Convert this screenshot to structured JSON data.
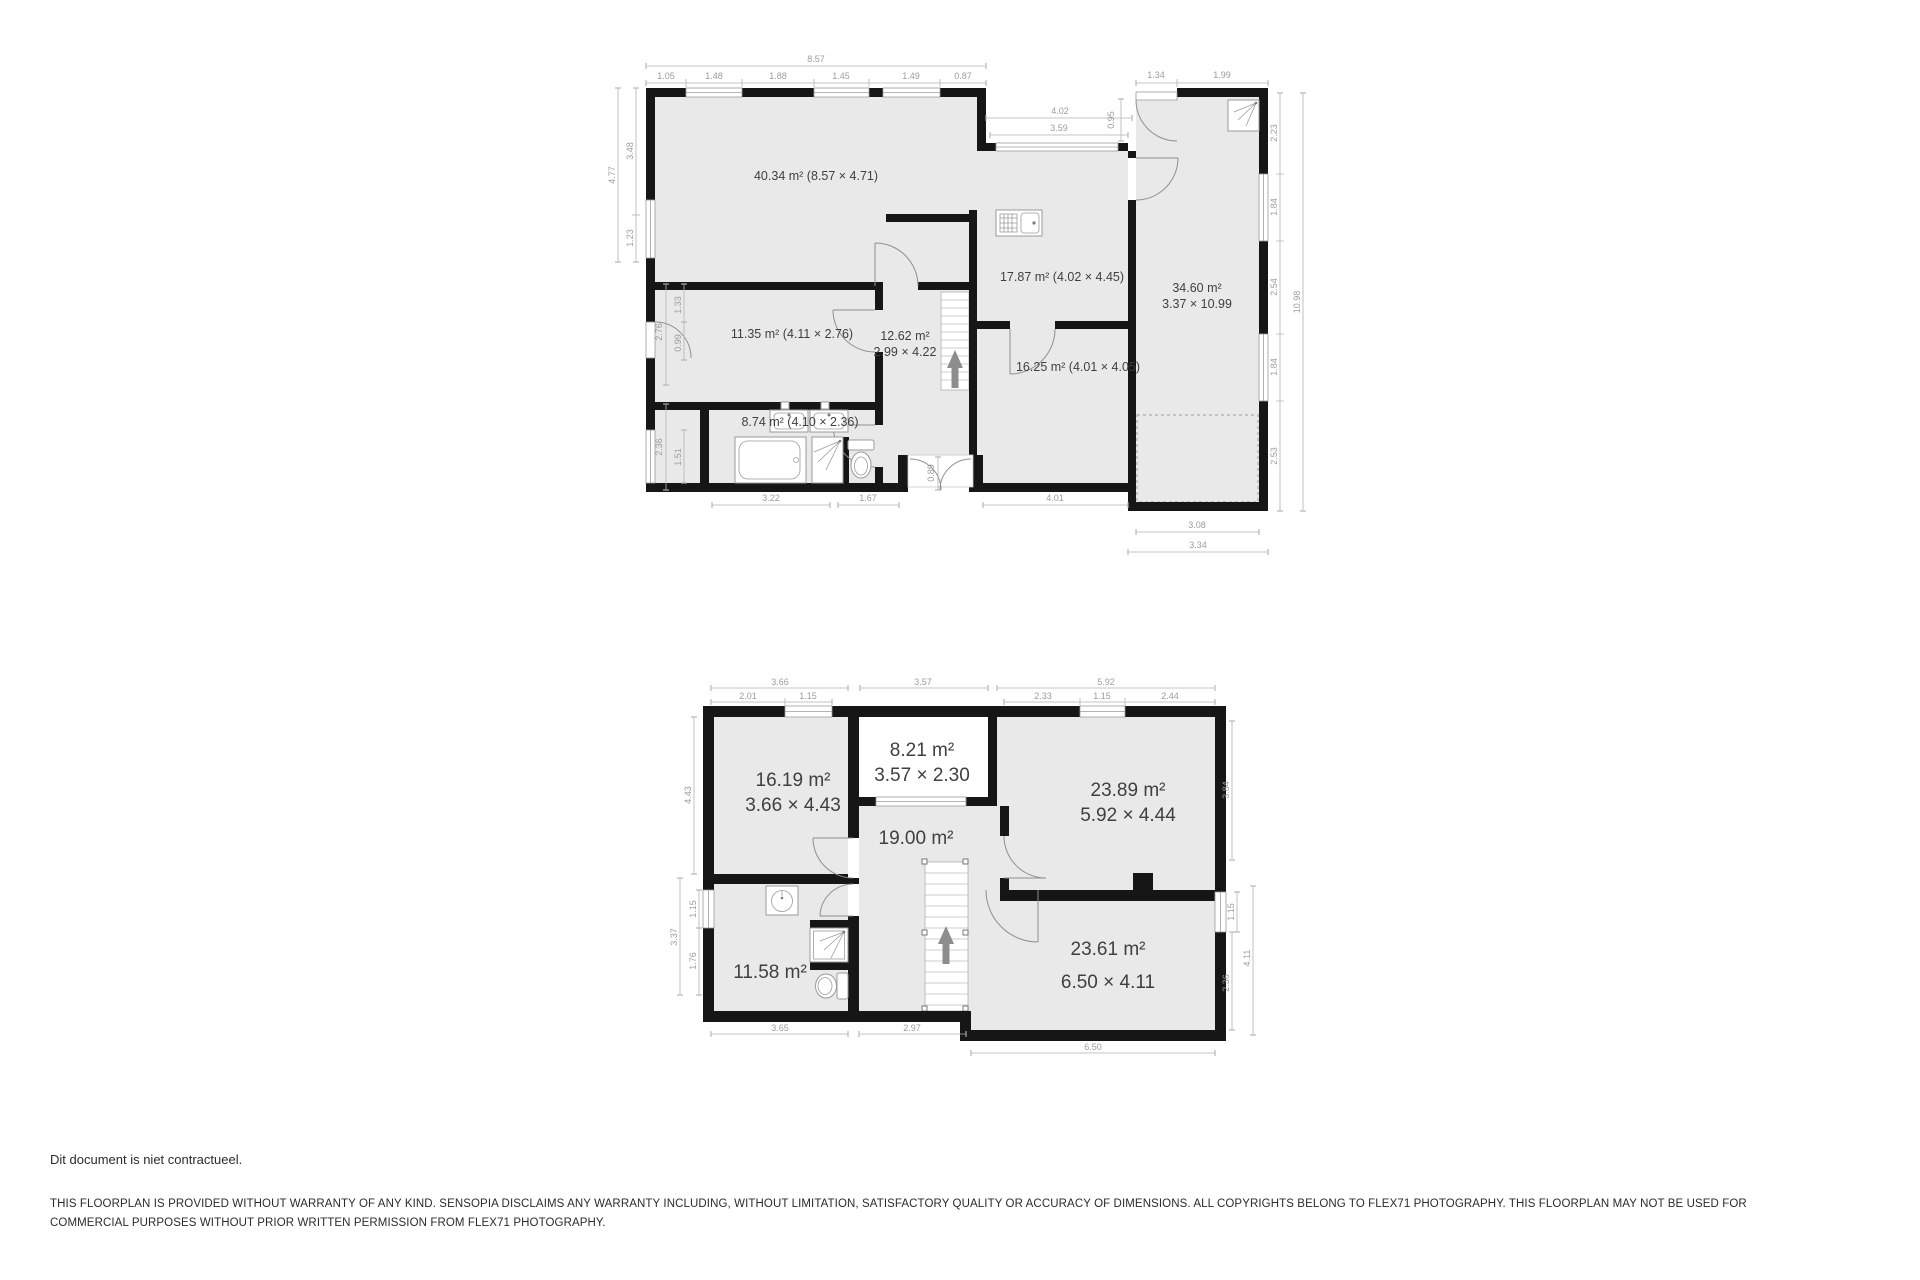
{
  "colors": {
    "wall": "#161616",
    "floor": "#e9e9e9",
    "dim_text": "#9c9c9c",
    "label_text": "#3f3f3f"
  },
  "upper_floor": {
    "rooms": {
      "living": "40.34 m² (8.57 × 4.71)",
      "kitchen": "17.87 m² (4.02 × 4.45)",
      "garage_area": "34.60 m²",
      "garage_size": "3.37 × 10.99",
      "bedroom": "11.35 m² (4.11 × 2.76)",
      "hall_area": "12.62 m²",
      "hall_size": "2.99 × 4.22",
      "dining": "16.25 m² (4.01 × 4.05)",
      "bathroom": "8.74 m² (4.10 × 2.36)"
    },
    "dims": {
      "top_total": "8.57",
      "t1": "1.05",
      "t2": "1.48",
      "t3": "1.88",
      "t4": "1.45",
      "t5": "1.49",
      "t6": "0.87",
      "band_outer": "4.02",
      "band_inner": "3.59",
      "band_depth": "0.95",
      "porch1": "1.34",
      "porch2": "1.99",
      "r1": "2.23",
      "r2": "1.84",
      "r3": "2.54",
      "r4": "1.84",
      "r5": "2.53",
      "r_total": "10.98",
      "l_total": "4.77",
      "l1": "3.48",
      "l2": "1.23",
      "l3": "2.76",
      "l4": "1.33",
      "l5": "0.99",
      "l6": "2.36",
      "l7": "1.51",
      "b1": "3.22",
      "b2": "1.67",
      "b3": "4.01",
      "entry": "0.89",
      "g1": "3.08",
      "g2": "3.34"
    }
  },
  "lower_floor": {
    "rooms": {
      "bed1_area": "16.19 m²",
      "bed1_size": "3.66 × 4.43",
      "dormer_area": "8.21 m²",
      "dormer_size": "3.57 × 2.30",
      "bed2_area": "23.89 m²",
      "bed2_size": "5.92 × 4.44",
      "landing_area": "19.00 m²",
      "bathroom_area": "11.58 m²",
      "bed3_area": "23.61 m²",
      "bed3_size": "6.50 × 4.11"
    },
    "dims": {
      "t_left_total": "3.66",
      "t1": "2.01",
      "t2": "1.15",
      "t_mid": "3.57",
      "t_right_total": "5.92",
      "t3": "2.33",
      "t4": "1.15",
      "t5": "2.44",
      "l1": "4.43",
      "l_total": "3.37",
      "l2": "1.15",
      "l3": "1.76",
      "r1": "3.84",
      "r2": "1.15",
      "r3": "2.36",
      "r_total": "4.11",
      "b1": "3.65",
      "b2": "2.97",
      "b3": "6.50"
    }
  },
  "footer": {
    "note": "Dit document is niet contractueel.",
    "disclaimer1": "THIS FLOORPLAN IS PROVIDED WITHOUT WARRANTY OF ANY KIND. SENSOPIA DISCLAIMS ANY WARRANTY INCLUDING, WITHOUT LIMITATION, SATISFACTORY QUALITY OR ACCURACY OF DIMENSIONS. ALL COPYRIGHTS BELONG TO FLEX71 PHOTOGRAPHY. THIS FLOORPLAN MAY NOT BE USED FOR",
    "disclaimer2": "COMMERCIAL PURPOSES WITHOUT PRIOR WRITTEN PERMISSION FROM FLEX71 PHOTOGRAPHY."
  }
}
